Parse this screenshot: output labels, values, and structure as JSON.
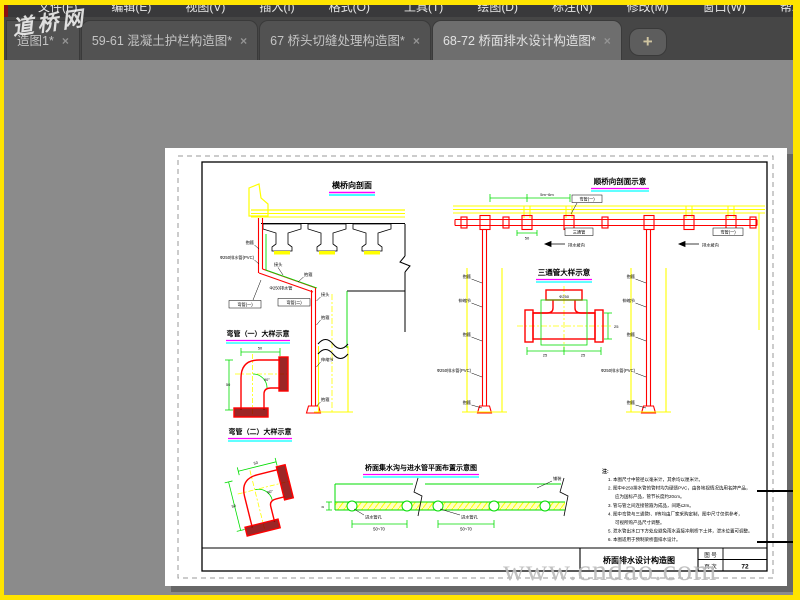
{
  "menu": {
    "items": [
      "文件(F)",
      "编辑(E)",
      "视图(V)",
      "插入(I)",
      "格式(O)",
      "工具(T)",
      "绘图(D)",
      "标注(N)",
      "修改(M)",
      "窗口(W)",
      "帮助(H)"
    ]
  },
  "tabs": {
    "close_glyph": "×",
    "new_tab_glyph": "+",
    "items": [
      {
        "label": "造图1*",
        "active": false
      },
      {
        "label": "59-61 混凝土护栏构造图*",
        "active": false
      },
      {
        "label": "67 桥头切缝处理构造图*",
        "active": false
      },
      {
        "label": "68-72 桥面排水设计构造图*",
        "active": true
      }
    ]
  },
  "watermarks": {
    "site_name": "道桥网",
    "site_url": "www.cndao.com"
  },
  "drawing": {
    "d1_title": "横桥向剖面",
    "d2_title": "顺桥向剖面示意",
    "d3_title": "三通管大样示意",
    "d4_title": "弯管（一）大样示意",
    "d5_title": "弯管（二）大样示意",
    "d6_title": "桥面集水沟与进水管平面布置示意图",
    "labels": {
      "baogu": "抱箍",
      "shensuojie": "伸缩节",
      "jietou": "接头",
      "pipe_spec": "Φ250排水管(PVC)",
      "pipe_short": "Φ250排水管",
      "wg1": "弯管(一)",
      "wg2": "弯管(二)",
      "santong": "三通管",
      "slope": "排水坡向",
      "inlet": "进水管孔",
      "dim_5070": "50~70",
      "dim_56": "5m~6m",
      "dim_25": "25",
      "dim_50": "50",
      "phi250": "Φ250",
      "deg90": "90°",
      "dim_8": "8",
      "paving": "铺装"
    },
    "notes": {
      "heading": "注:",
      "lines": [
        "1. 本图尺寸中管径以毫米计，其余均以厘米计。",
        "2. 图中Φ250排水管的管材均为硬质PVC，由各地视情况选用名牌产品，",
        "应为国标产品，管节长度约20cm。",
        "3. 管与管之间连接管箍为成品，间距≤2m。",
        "4. 图中弯管与三通管Ⅰ、Ⅱ等均由厂家采购定制，图中尺寸仅供参考，",
        "可视所购产品尺寸调整。",
        "5. 泄水管出水口下方处应避免雨水直接冲刷桥下土体，泄水位置可调整。",
        "6. 本图适用于预制梁桥面排水设计。"
      ]
    },
    "title_block": {
      "drawing_title": "桥面排水设计构造图",
      "fig_no_label": "图 号",
      "page_label": "页 次",
      "page_value": "72"
    }
  }
}
